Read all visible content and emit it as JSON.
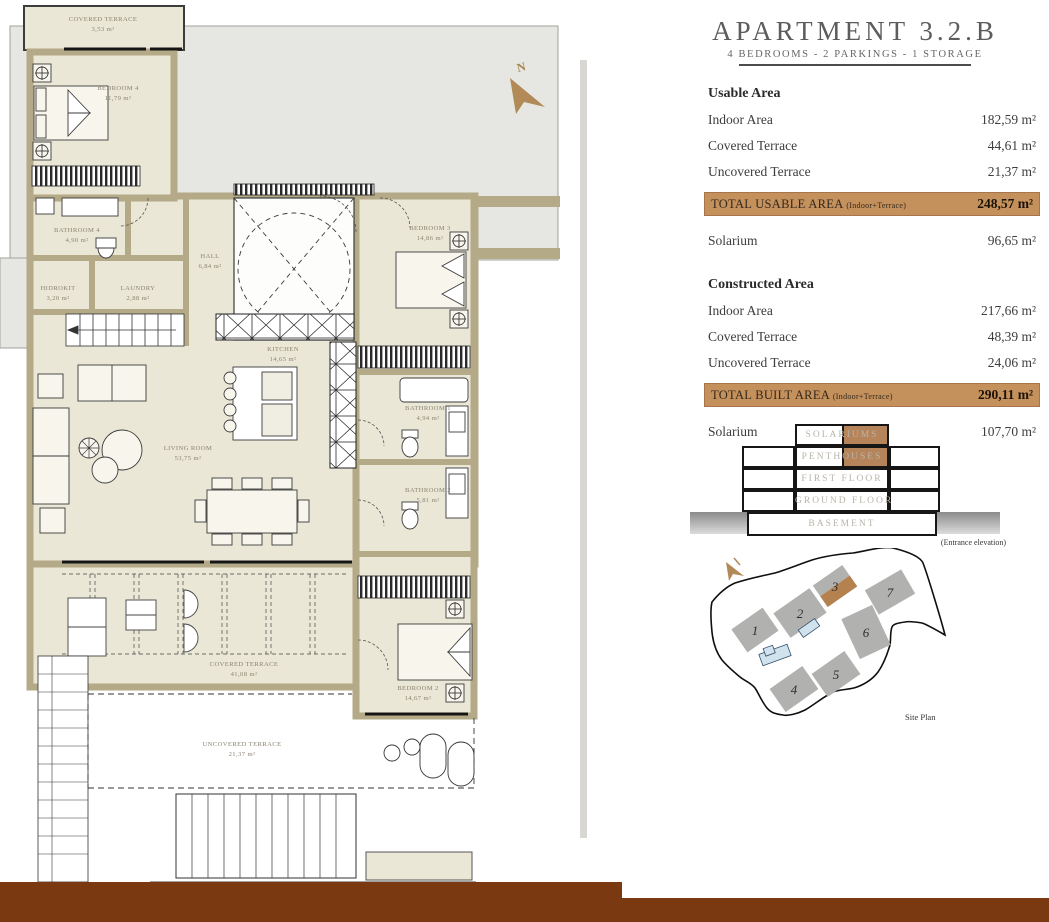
{
  "header": {
    "title": "APARTMENT 3.2.B",
    "subtitle": "4 BEDROOMS - 2 PARKINGS - 1 STORAGE"
  },
  "areas": {
    "usable": {
      "heading": "Usable Area",
      "rows": [
        {
          "label": "Indoor Area",
          "value": "182,59 m²"
        },
        {
          "label": "Covered Terrace",
          "value": "44,61 m²"
        },
        {
          "label": "Uncovered Terrace",
          "value": "21,37 m²"
        }
      ],
      "total": {
        "label": "TOTAL USABLE AREA",
        "note": "(Indoor+Terrace)",
        "value": "248,57 m²"
      },
      "solarium": {
        "label": "Solarium",
        "value": "96,65 m²"
      }
    },
    "constructed": {
      "heading": "Constructed Area",
      "rows": [
        {
          "label": "Indoor Area",
          "value": "217,66 m²"
        },
        {
          "label": "Covered Terrace",
          "value": "48,39 m²"
        },
        {
          "label": "Uncovered Terrace",
          "value": "24,06 m²"
        }
      ],
      "total": {
        "label": "TOTAL BUILT AREA",
        "note": "(Indoor+Terrace)",
        "value": "290,11 m²"
      },
      "solarium": {
        "label": "Solarium",
        "value": "107,70 m²"
      }
    }
  },
  "elevation": {
    "floors": [
      "SOLARIUMS",
      "PENTHOUSES",
      "FIRST FLOOR",
      "GROUND FLOOR",
      "BASEMENT"
    ],
    "caption": "(Entrance elevation)"
  },
  "site": {
    "numbers": [
      "1",
      "2",
      "3",
      "4",
      "5",
      "6",
      "7"
    ],
    "caption": "Site Plan"
  },
  "floorplan": {
    "compass": "N",
    "rooms": [
      {
        "name": "COVERED TERRACE",
        "area": "3,53 m²"
      },
      {
        "name": "BEDROOM 4",
        "area": "11,79 m²"
      },
      {
        "name": "BATHROOM 4",
        "area": "4,90 m²"
      },
      {
        "name": "HIDROKIT",
        "area": "3,20 m²"
      },
      {
        "name": "LAUNDRY",
        "area": "2,88 m²"
      },
      {
        "name": "HALL",
        "area": "6,84 m²"
      },
      {
        "name": "KITCHEN",
        "area": "14,65 m²"
      },
      {
        "name": "BEDROOM 3",
        "area": "14,86 m²"
      },
      {
        "name": "LIVING ROOM",
        "area": "53,75 m²"
      },
      {
        "name": "BATHROOM 1",
        "area": "4,94 m²"
      },
      {
        "name": "BATHROOM 2",
        "area": "5,81 m²"
      },
      {
        "name": "BEDROOM 2",
        "area": "14,67 m²"
      },
      {
        "name": "COVERED TERRACE",
        "area": "41,08 m²"
      },
      {
        "name": "UNCOVERED TERRACE",
        "area": "21,37 m²"
      }
    ]
  },
  "colors": {
    "accent_tan": "#c4905c",
    "wall": "#b4aa87",
    "room_fill": "#eae7d6",
    "bottom_bar": "#7a3910",
    "elevation_highlight": "#b5845a"
  }
}
